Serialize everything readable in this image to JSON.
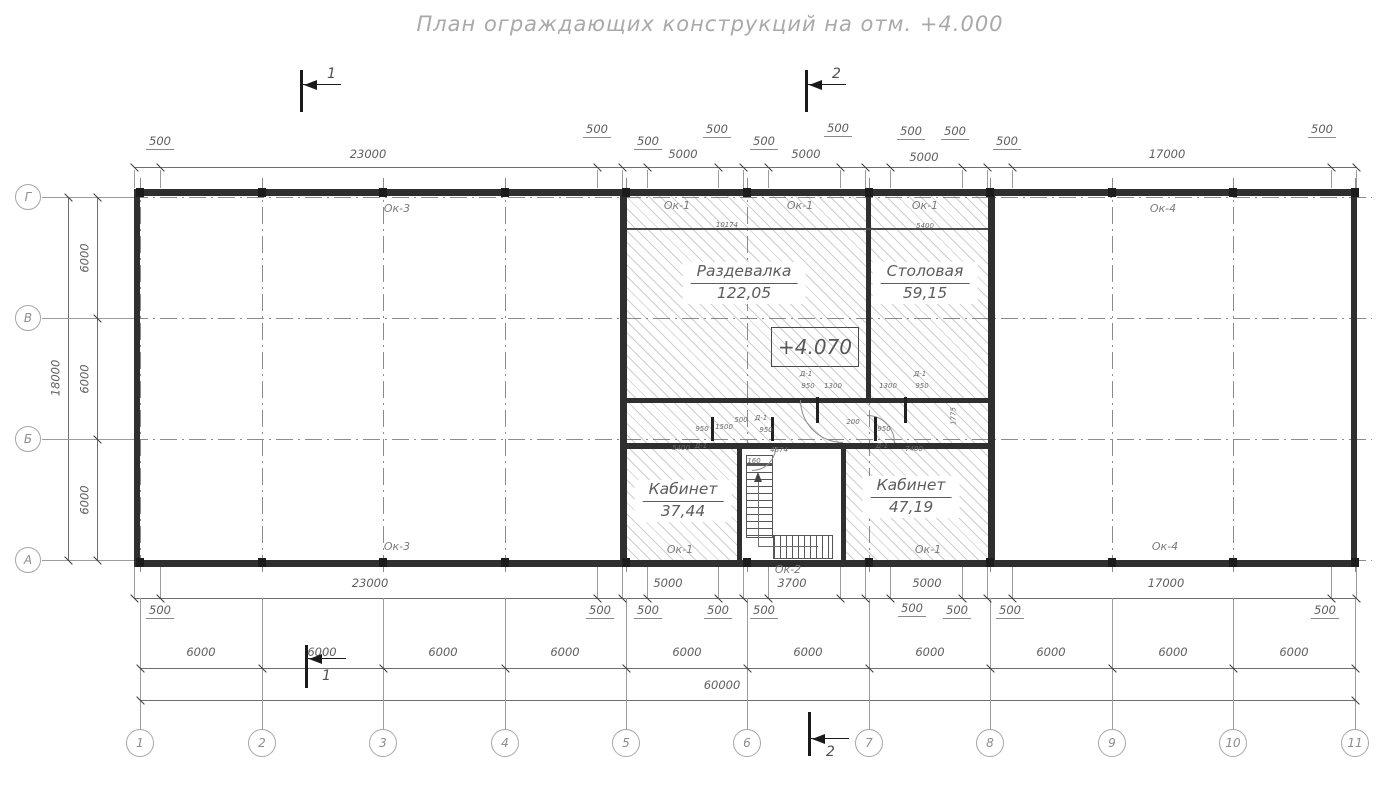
{
  "title": "План ограждающих конструкций на отм. +4.000",
  "elevation": "+4.070",
  "section_markers": [
    {
      "label": "1",
      "x": 300,
      "y": 70,
      "h": 42,
      "ly": 66,
      "lx": 327,
      "ay": 84
    },
    {
      "label": "2",
      "x": 805,
      "y": 70,
      "h": 42,
      "ly": 66,
      "lx": 832,
      "ay": 84
    },
    {
      "label": "1",
      "x": 305,
      "y": 645,
      "h": 43,
      "ly": 668,
      "lx": 322,
      "ay": 658
    },
    {
      "label": "2",
      "x": 808,
      "y": 712,
      "h": 44,
      "ly": 744,
      "lx": 826,
      "ay": 738
    }
  ],
  "grid": {
    "rows": [
      {
        "label": "Г",
        "y": 197
      },
      {
        "label": "В",
        "y": 318
      },
      {
        "label": "Б",
        "y": 439
      },
      {
        "label": "А",
        "y": 560
      }
    ],
    "cols": [
      {
        "label": "1",
        "x": 140
      },
      {
        "label": "2",
        "x": 262
      },
      {
        "label": "3",
        "x": 383
      },
      {
        "label": "4",
        "x": 505
      },
      {
        "label": "5",
        "x": 626
      },
      {
        "label": "6",
        "x": 747
      },
      {
        "label": "7",
        "x": 869
      },
      {
        "label": "8",
        "x": 990
      },
      {
        "label": "9",
        "x": 1112
      },
      {
        "label": "10",
        "x": 1233
      },
      {
        "label": "11",
        "x": 1355
      }
    ]
  },
  "rooms": [
    {
      "name": "Раздевалка",
      "area": "122,05",
      "x": 744,
      "y": 262
    },
    {
      "name": "Столовая",
      "area": "59,15",
      "x": 925,
      "y": 262
    },
    {
      "name": "Кабинет",
      "area": "37,44",
      "x": 683,
      "y": 480
    },
    {
      "name": "Кабинет",
      "area": "47,19",
      "x": 911,
      "y": 476
    }
  ],
  "window_labels": [
    {
      "t": "Ок-3",
      "x": 397,
      "y": 203
    },
    {
      "t": "Ок-1",
      "x": 677,
      "y": 200
    },
    {
      "t": "Ок-1",
      "x": 800,
      "y": 200
    },
    {
      "t": "Ок-1",
      "x": 925,
      "y": 200
    },
    {
      "t": "Ок-4",
      "x": 1163,
      "y": 203
    },
    {
      "t": "Ок-3",
      "x": 397,
      "y": 541
    },
    {
      "t": "Ок-1",
      "x": 680,
      "y": 544
    },
    {
      "t": "Ок-1",
      "x": 928,
      "y": 544
    },
    {
      "t": "Ок-4",
      "x": 1165,
      "y": 541
    },
    {
      "t": "Ок-2",
      "x": 788,
      "y": 564
    }
  ],
  "dim_labels": [
    {
      "t": "500",
      "x": 160,
      "y": 136,
      "u": 1
    },
    {
      "t": "23000",
      "x": 368,
      "y": 149
    },
    {
      "t": "500",
      "x": 597,
      "y": 124,
      "u": 1
    },
    {
      "t": "500",
      "x": 648,
      "y": 136,
      "u": 1
    },
    {
      "t": "5000",
      "x": 683,
      "y": 149
    },
    {
      "t": "500",
      "x": 717,
      "y": 124,
      "u": 1
    },
    {
      "t": "500",
      "x": 764,
      "y": 136,
      "u": 1
    },
    {
      "t": "5000",
      "x": 806,
      "y": 149
    },
    {
      "t": "500",
      "x": 838,
      "y": 123,
      "u": 1
    },
    {
      "t": "500",
      "x": 911,
      "y": 126,
      "u": 1
    },
    {
      "t": "5000",
      "x": 924,
      "y": 152
    },
    {
      "t": "500",
      "x": 955,
      "y": 126,
      "u": 1
    },
    {
      "t": "500",
      "x": 1007,
      "y": 136,
      "u": 1
    },
    {
      "t": "17000",
      "x": 1167,
      "y": 149
    },
    {
      "t": "500",
      "x": 1322,
      "y": 124,
      "u": 1
    },
    {
      "t": "500",
      "x": 160,
      "y": 605,
      "u": 1
    },
    {
      "t": "23000",
      "x": 370,
      "y": 578
    },
    {
      "t": "500",
      "x": 600,
      "y": 605,
      "u": 1
    },
    {
      "t": "500",
      "x": 648,
      "y": 605,
      "u": 1
    },
    {
      "t": "5000",
      "x": 668,
      "y": 578
    },
    {
      "t": "500",
      "x": 718,
      "y": 605,
      "u": 1
    },
    {
      "t": "500",
      "x": 764,
      "y": 605,
      "u": 1
    },
    {
      "t": "3700",
      "x": 792,
      "y": 578
    },
    {
      "t": "500",
      "x": 912,
      "y": 603,
      "u": 1
    },
    {
      "t": "5000",
      "x": 927,
      "y": 578
    },
    {
      "t": "500",
      "x": 957,
      "y": 605,
      "u": 1
    },
    {
      "t": "500",
      "x": 1010,
      "y": 605,
      "u": 1
    },
    {
      "t": "17000",
      "x": 1166,
      "y": 578
    },
    {
      "t": "500",
      "x": 1325,
      "y": 605,
      "u": 1
    },
    {
      "t": "6000",
      "x": 201,
      "y": 647
    },
    {
      "t": "6000",
      "x": 322,
      "y": 647
    },
    {
      "t": "6000",
      "x": 443,
      "y": 647
    },
    {
      "t": "6000",
      "x": 565,
      "y": 647
    },
    {
      "t": "6000",
      "x": 687,
      "y": 647
    },
    {
      "t": "6000",
      "x": 808,
      "y": 647
    },
    {
      "t": "6000",
      "x": 930,
      "y": 647
    },
    {
      "t": "6000",
      "x": 1051,
      "y": 647
    },
    {
      "t": "6000",
      "x": 1173,
      "y": 647
    },
    {
      "t": "6000",
      "x": 1294,
      "y": 647
    },
    {
      "t": "60000",
      "x": 722,
      "y": 680
    },
    {
      "t": "6000",
      "x": 85,
      "y": 258,
      "rot": 1
    },
    {
      "t": "6000",
      "x": 85,
      "y": 379,
      "rot": 1
    },
    {
      "t": "6000",
      "x": 85,
      "y": 500,
      "rot": 1
    },
    {
      "t": "18000",
      "x": 56,
      "y": 378,
      "rot": 1
    }
  ],
  "tiny_labels": [
    {
      "t": "10174",
      "x": 727,
      "y": 222
    },
    {
      "t": "5400",
      "x": 925,
      "y": 223
    },
    {
      "t": "1800",
      "x": 954,
      "y": 292,
      "rot": 1
    },
    {
      "t": "Д-1",
      "x": 806,
      "y": 371
    },
    {
      "t": "950",
      "x": 808,
      "y": 383
    },
    {
      "t": "1300",
      "x": 833,
      "y": 383
    },
    {
      "t": "1300",
      "x": 888,
      "y": 383
    },
    {
      "t": "950",
      "x": 922,
      "y": 383
    },
    {
      "t": "Д-1",
      "x": 920,
      "y": 371
    },
    {
      "t": "950",
      "x": 702,
      "y": 426
    },
    {
      "t": "1500",
      "x": 724,
      "y": 424
    },
    {
      "t": "500",
      "x": 741,
      "y": 417
    },
    {
      "t": "Д-1",
      "x": 761,
      "y": 415
    },
    {
      "t": "950",
      "x": 766,
      "y": 427
    },
    {
      "t": "200",
      "x": 853,
      "y": 419
    },
    {
      "t": "950",
      "x": 884,
      "y": 426
    },
    {
      "t": "5400",
      "x": 681,
      "y": 445
    },
    {
      "t": "Д-1",
      "x": 701,
      "y": 443
    },
    {
      "t": "4674",
      "x": 779,
      "y": 447
    },
    {
      "t": "Д-1",
      "x": 882,
      "y": 443
    },
    {
      "t": "7400",
      "x": 914,
      "y": 446
    },
    {
      "t": "1775",
      "x": 954,
      "y": 416,
      "rot": 1
    },
    {
      "t": "160",
      "x": 754,
      "y": 458
    }
  ]
}
